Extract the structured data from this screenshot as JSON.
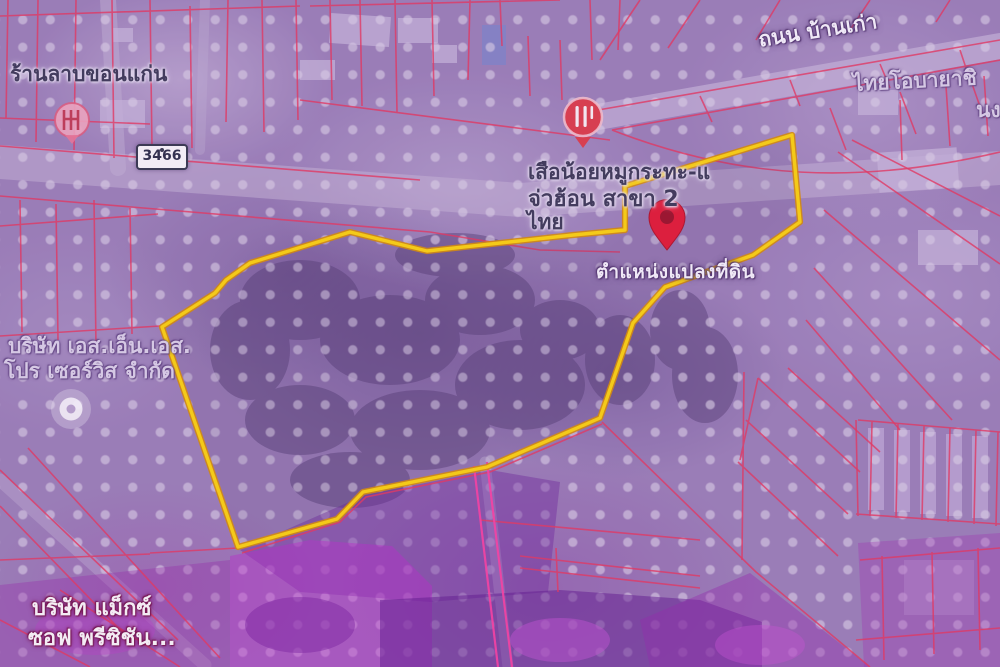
{
  "map": {
    "type": "satellite-cadastral-overlay",
    "route_badge": "3466",
    "labels": {
      "shop_top_left": "ร้านลาบขอนแก่น",
      "road_top_right": "ถนน บ้านเก่า",
      "company_top_right_line1": "ไทยโอบายาชิ",
      "company_top_right_line2": "นงเชื",
      "restaurant_line1": "เสือน้อยหมูกระทะ-แ",
      "restaurant_line2": "จ่วฮ้อน สาขา 2",
      "restaurant_line3": "ไทย",
      "parcel_marker_caption": "ตำแหน่งแปลงที่ดิน",
      "company_left_line1": "บริษัท เอส.เอ็น.เอส.",
      "company_left_line2": "โปร เซอร์วิส จำกัด",
      "company_bottom_left_line1": "บริษัท แม็กซ์",
      "company_bottom_left_line2": "ซอฟ พรีซิชัน..."
    },
    "parcel_polygon_points": "350,232 427,251 573,235 625,230 625,186 792,135 800,222 753,255 665,287 633,323 600,418 487,467 363,492 337,519 238,547 162,327 215,293 226,280 250,263",
    "colors": {
      "parcel_outline_yellow": "#ffd606",
      "parcel_outline_edge": "#d98e00",
      "cadastral_line_red": "#e8365a",
      "road_line_pink": "#ff3fa0",
      "location_pin_red": "#e5182f",
      "overlay_magenta": "#b32bc0",
      "halftone_dot": "#dfd5e7",
      "base_purple": "#9b80b6"
    }
  }
}
